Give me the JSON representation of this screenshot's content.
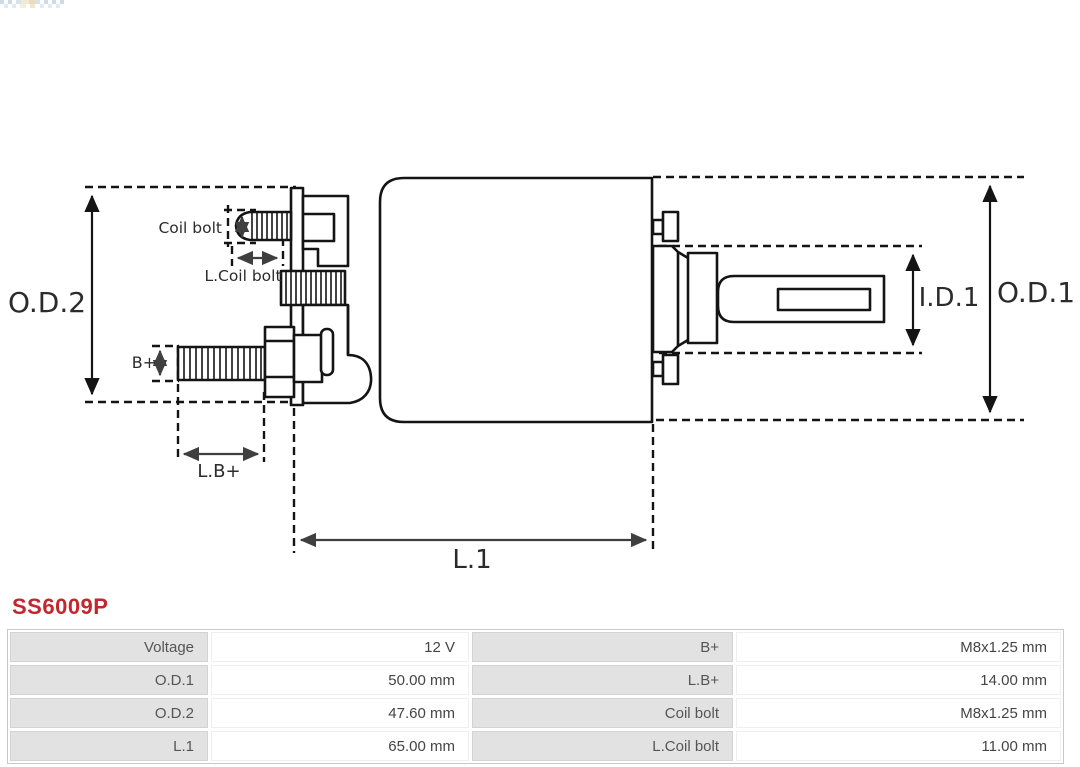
{
  "part_number": "SS6009P",
  "icons": {
    "logo": "as-pl-checkered-flag-logo"
  },
  "diagram": {
    "type": "technical-drawing",
    "subject": "starter solenoid side view with dimension lines",
    "line_color": "#141414",
    "dimension_arrow_color": "#3f3f3f",
    "labels": {
      "od2": "O.D.2",
      "od1": "O.D.1",
      "id1": "I.D.1",
      "l1": "L.1",
      "coil_bolt": "Coil bolt",
      "l_coil_bolt": "L.Coil bolt",
      "b_plus": "B+",
      "l_b_plus": "L.B+"
    }
  },
  "table": {
    "rows": [
      [
        "Voltage",
        "12 V",
        "B+",
        "M8x1.25 mm"
      ],
      [
        "O.D.1",
        "50.00 mm",
        "L.B+",
        "14.00 mm"
      ],
      [
        "O.D.2",
        "47.60 mm",
        "Coil bolt",
        "M8x1.25 mm"
      ],
      [
        "L.1",
        "65.00 mm",
        "L.Coil bolt",
        "11.00 mm"
      ]
    ]
  },
  "colors": {
    "part_number_red": "#c2272d",
    "table_label_bg": "#e2e2e2",
    "table_border": "#c9c9c9",
    "table_text": "#555555"
  }
}
